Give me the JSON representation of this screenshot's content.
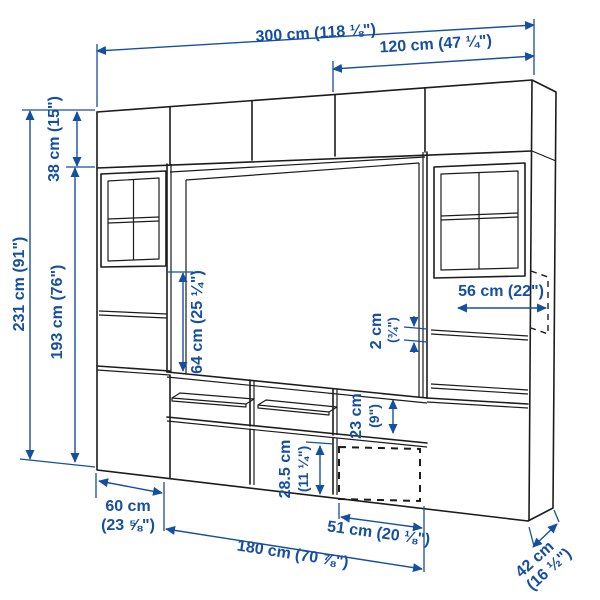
{
  "diagram": {
    "subject": "tv-storage-combination-dimension-drawing",
    "style": "line-art-perspective"
  },
  "colors": {
    "dimension_blue": "#164fa2",
    "outline_black": "#1c1c1c",
    "background": "#ffffff"
  },
  "dims": {
    "total_width": "300 cm (118 ⅛\")",
    "upper_right_width": "120 cm (47 ¼\")",
    "top_cabinet_height": "38 cm (15\")",
    "total_height": "231 cm (91\")",
    "cabinet_height": "193 cm (76\")",
    "open_shelf_height": "64 cm (25 ¼\")",
    "shelf_width": "56 cm (22\")",
    "shelf_thickness_cm": "2 cm",
    "shelf_thickness_in": "(¾\")",
    "niche_height_cm": "23 cm",
    "niche_height_in": "(9\")",
    "drawer_front_height_cm": "28.5 cm",
    "drawer_front_height_in": "(11 ¼\")",
    "unit_width_cm": "60 cm",
    "unit_width_in": "(23 ⅝\")",
    "bench_width": "180 cm (70 ⅞\")",
    "door_width": "51 cm (20 ⅛\")",
    "depth_cm": "42 cm",
    "depth_in": "(16 ½\")"
  }
}
